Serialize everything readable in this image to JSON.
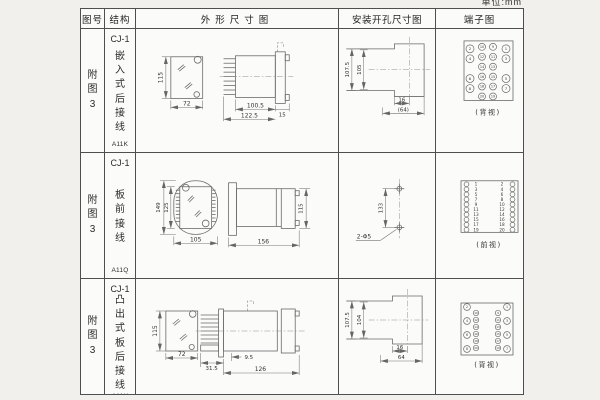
{
  "unit_label": "单位:mm",
  "headers": {
    "fig": "图号",
    "structure": "结构",
    "outline": "外形尺寸图",
    "mounting": "安装开孔尺寸图",
    "terminal": "端子图"
  },
  "rows": [
    {
      "fig": "附图3",
      "model": "CJ-1",
      "mount_type": "嵌入式后接线",
      "code": "A11K",
      "outline": {
        "h": "115",
        "w": "72",
        "body": "100.5",
        "total": "122.5",
        "flange": "15"
      },
      "mounting": {
        "outer_h": "107.5",
        "inner_h": "105",
        "notch_w": "16",
        "width": "(64)"
      },
      "terminal_view": "(背视)"
    },
    {
      "fig": "附图3",
      "model": "CJ-1",
      "mount_type": "板前接线",
      "code": "A11Q",
      "outline": {
        "outer_h": "149",
        "inner_h": "125",
        "w": "105",
        "len": "156",
        "side_h": "115"
      },
      "mounting": {
        "pitch": "133",
        "holes": "2-Φ5"
      },
      "terminal_view": "(前视)"
    },
    {
      "fig": "附图3",
      "model": "CJ-1",
      "mount_type": "凸出式板后接线",
      "code": "A11H",
      "outline": {
        "h": "115",
        "w": "72",
        "pins_w": "31.5",
        "step": "9.5",
        "len": "126"
      },
      "mounting": {
        "outer_h": "107.5",
        "inner_h": "104",
        "notch_w": "16",
        "width": "64"
      },
      "terminal_view": "(背视)"
    }
  ],
  "pins": {
    "a11k_rows": [
      [
        "2",
        "10",
        "9",
        "1"
      ],
      [
        "4",
        "12",
        "11",
        "3"
      ],
      [
        "",
        "14",
        "13",
        ""
      ],
      [
        "6",
        "16",
        "15",
        "5"
      ],
      [
        "8",
        "18",
        "17",
        "7"
      ],
      [
        "",
        "20",
        "19",
        ""
      ]
    ],
    "a11q_rows": [
      [
        "1",
        "2"
      ],
      [
        "3",
        "4"
      ],
      [
        "5",
        "6"
      ],
      [
        "7",
        "8"
      ],
      [
        "9",
        "10"
      ],
      [
        "11",
        "12"
      ],
      [
        "13",
        "14"
      ],
      [
        "15",
        "16"
      ],
      [
        "17",
        "18"
      ],
      [
        "19",
        "20"
      ]
    ],
    "a11h": {
      "left_big": [
        "2",
        "4",
        "6",
        "8"
      ],
      "left_small": [
        "10",
        "12",
        "14",
        "16",
        "18",
        "20"
      ],
      "right_big": [
        "1",
        "3",
        "5",
        "7"
      ],
      "right_small": [
        "9",
        "11",
        "13",
        "15",
        "17",
        "19"
      ]
    }
  }
}
